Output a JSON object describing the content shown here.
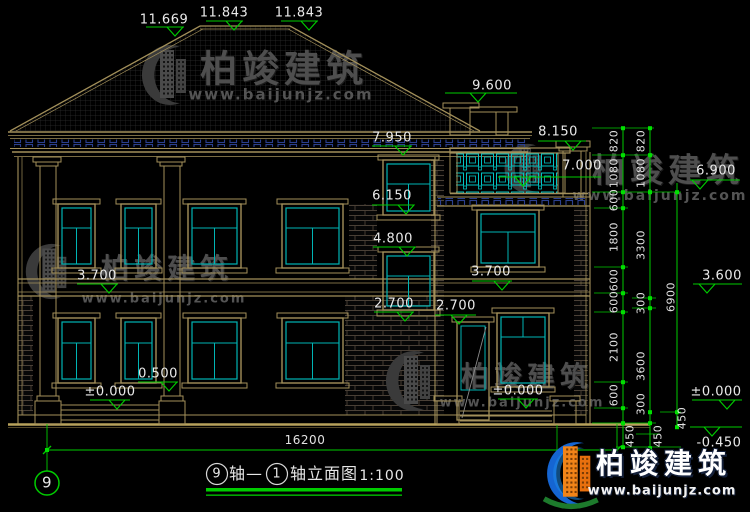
{
  "drawing": {
    "type": "building-elevation",
    "title": {
      "axis_left": "9",
      "mid": "轴—",
      "axis_right": "1",
      "suffix": "轴立面图",
      "scale": "1:100"
    },
    "axis_bubble": "9",
    "total_width_dim": "16200",
    "accent_colors": {
      "line_green": "#00cc00",
      "line_tan": "#a3905a",
      "line_cyan": "#00b4b4",
      "dentil_navy": "#2b3f8e",
      "text_white": "#eaeaea",
      "watermark_gray": "#4e4e4e",
      "logo_blue": "#1565d2",
      "logo_orange": "#f28418",
      "logo_green": "#1d7a2c"
    },
    "level_markers": [
      "11.669",
      "11.843",
      "11.843",
      "9.600",
      "8.150",
      "7.950",
      "7.000",
      "6.900",
      "6.150",
      "4.800",
      "3.700",
      "3.700",
      "3.600",
      "2.700",
      "2.700",
      "0.500",
      "±0.000",
      "±0.000",
      "±0.000",
      "-0.450"
    ],
    "right_dim_chain_1": [
      "820",
      "1080",
      "600",
      "1800",
      "600",
      "600",
      "2100",
      "600",
      "450"
    ],
    "right_dim_chain_2": [
      "820",
      "1080",
      "3300",
      "300",
      "3600",
      "300",
      "450"
    ],
    "right_dim_total": [
      "6900",
      "450"
    ]
  },
  "watermark": {
    "brand": "柏竣建筑",
    "url": "www.baijunjz.com"
  },
  "labels": [
    {
      "n": "watermark-brand",
      "t": "柏竣建筑",
      "x": 284,
      "y": 69,
      "fs": 37,
      "cls": "wmbig",
      "layer": "wm"
    },
    {
      "n": "watermark-url",
      "t": "www.baijunjz.com",
      "x": 281,
      "y": 95,
      "fs": 15,
      "cls": "wmurl",
      "layer": "wm"
    },
    {
      "n": "watermark-brand",
      "t": "柏竣建筑",
      "x": 668,
      "y": 170,
      "fs": 33,
      "cls": "wmbig",
      "layer": "wm"
    },
    {
      "n": "watermark-url",
      "t": "www.baijunjz.com",
      "x": 660,
      "y": 196,
      "fs": 14,
      "cls": "wmurl",
      "layer": "wm"
    },
    {
      "n": "watermark-brand",
      "t": "柏竣建筑",
      "x": 167,
      "y": 269,
      "fs": 28,
      "cls": "wmbig",
      "layer": "wm"
    },
    {
      "n": "watermark-url",
      "t": "www.baijunjz.com",
      "x": 164,
      "y": 299,
      "fs": 13,
      "cls": "wmurl",
      "layer": "wm"
    },
    {
      "n": "watermark-brand",
      "t": "柏竣建筑",
      "x": 527,
      "y": 377,
      "fs": 28,
      "cls": "wmbig",
      "layer": "wm"
    },
    {
      "n": "watermark-url",
      "t": "www.baijunjz.com",
      "x": 522,
      "y": 403,
      "fs": 13,
      "cls": "wmurl",
      "layer": "wm"
    },
    {
      "n": "level-label",
      "t": "11.669",
      "x": 164,
      "y": 20,
      "fs": 13,
      "cls": "lvl"
    },
    {
      "n": "level-label",
      "t": "11.843",
      "x": 224,
      "y": 13,
      "fs": 13,
      "cls": "lvl"
    },
    {
      "n": "level-label",
      "t": "11.843",
      "x": 299,
      "y": 13,
      "fs": 13,
      "cls": "lvl"
    },
    {
      "n": "level-label",
      "t": "9.600",
      "x": 492,
      "y": 86,
      "fs": 13,
      "cls": "lvl"
    },
    {
      "n": "level-label",
      "t": "8.150",
      "x": 558,
      "y": 132,
      "fs": 13,
      "cls": "lvl"
    },
    {
      "n": "level-label",
      "t": "7.950",
      "x": 392,
      "y": 138,
      "fs": 13,
      "cls": "lvl"
    },
    {
      "n": "level-label",
      "t": "7.000",
      "x": 582,
      "y": 166,
      "fs": 13,
      "cls": "lvl"
    },
    {
      "n": "level-label",
      "t": "6.900",
      "x": 716,
      "y": 171,
      "fs": 13,
      "cls": "lvl"
    },
    {
      "n": "level-label",
      "t": "6.150",
      "x": 392,
      "y": 196,
      "fs": 13,
      "cls": "lvl"
    },
    {
      "n": "level-label",
      "t": "4.800",
      "x": 393,
      "y": 239,
      "fs": 13,
      "cls": "lvl"
    },
    {
      "n": "level-label",
      "t": "3.700",
      "x": 97,
      "y": 276,
      "fs": 13,
      "cls": "lvl"
    },
    {
      "n": "level-label",
      "t": "3.700",
      "x": 491,
      "y": 272,
      "fs": 13,
      "cls": "lvl"
    },
    {
      "n": "level-label",
      "t": "3.600",
      "x": 722,
      "y": 276,
      "fs": 13,
      "cls": "lvl"
    },
    {
      "n": "level-label",
      "t": "2.700",
      "x": 394,
      "y": 304,
      "fs": 13,
      "cls": "lvl"
    },
    {
      "n": "level-label",
      "t": "2.700",
      "x": 456,
      "y": 306,
      "fs": 13,
      "cls": "lvl"
    },
    {
      "n": "level-label",
      "t": "0.500",
      "x": 158,
      "y": 374,
      "fs": 13,
      "cls": "lvl"
    },
    {
      "n": "level-label",
      "t": "±0.000",
      "x": 110,
      "y": 392,
      "fs": 13,
      "cls": "lvl"
    },
    {
      "n": "level-label",
      "t": "±0.000",
      "x": 518,
      "y": 391,
      "fs": 13,
      "cls": "lvl"
    },
    {
      "n": "level-label",
      "t": "±0.000",
      "x": 716,
      "y": 392,
      "fs": 13,
      "cls": "lvl"
    },
    {
      "n": "level-label",
      "t": "-0.450",
      "x": 719,
      "y": 443,
      "fs": 13,
      "cls": "lvl"
    },
    {
      "n": "dim-total-width",
      "t": "16200",
      "x": 305,
      "y": 440,
      "fs": 12,
      "cls": "dim"
    },
    {
      "n": "dim-chain1",
      "t": "820",
      "x": 614,
      "y": 141,
      "fs": 11,
      "cls": "dim",
      "rot": 1
    },
    {
      "n": "dim-chain1",
      "t": "1080",
      "x": 614,
      "y": 173,
      "fs": 11,
      "cls": "dim",
      "rot": 1
    },
    {
      "n": "dim-chain1",
      "t": "600",
      "x": 614,
      "y": 200,
      "fs": 11,
      "cls": "dim",
      "rot": 1
    },
    {
      "n": "dim-chain1",
      "t": "1800",
      "x": 614,
      "y": 237,
      "fs": 11,
      "cls": "dim",
      "rot": 1
    },
    {
      "n": "dim-chain1",
      "t": "600",
      "x": 614,
      "y": 280,
      "fs": 11,
      "cls": "dim",
      "rot": 1
    },
    {
      "n": "dim-chain1",
      "t": "600",
      "x": 614,
      "y": 302,
      "fs": 11,
      "cls": "dim",
      "rot": 1
    },
    {
      "n": "dim-chain1",
      "t": "2100",
      "x": 614,
      "y": 347,
      "fs": 11,
      "cls": "dim",
      "rot": 1
    },
    {
      "n": "dim-chain1",
      "t": "600",
      "x": 614,
      "y": 395,
      "fs": 11,
      "cls": "dim",
      "rot": 1
    },
    {
      "n": "dim-chain1",
      "t": "450",
      "x": 630,
      "y": 436,
      "fs": 11,
      "cls": "dim",
      "rot": 1
    },
    {
      "n": "dim-chain2",
      "t": "820",
      "x": 641,
      "y": 141,
      "fs": 11,
      "cls": "dim",
      "rot": 1
    },
    {
      "n": "dim-chain2",
      "t": "1080",
      "x": 641,
      "y": 173,
      "fs": 11,
      "cls": "dim",
      "rot": 1
    },
    {
      "n": "dim-chain2",
      "t": "3300",
      "x": 641,
      "y": 245,
      "fs": 11,
      "cls": "dim",
      "rot": 1
    },
    {
      "n": "dim-chain2",
      "t": "300",
      "x": 641,
      "y": 303,
      "fs": 11,
      "cls": "dim",
      "rot": 1
    },
    {
      "n": "dim-chain2",
      "t": "3600",
      "x": 641,
      "y": 366,
      "fs": 11,
      "cls": "dim",
      "rot": 1
    },
    {
      "n": "dim-chain2",
      "t": "300",
      "x": 641,
      "y": 404,
      "fs": 11,
      "cls": "dim",
      "rot": 1
    },
    {
      "n": "dim-chain2",
      "t": "450",
      "x": 658,
      "y": 436,
      "fs": 11,
      "cls": "dim",
      "rot": 1
    },
    {
      "n": "dim-total-height",
      "t": "6900",
      "x": 671,
      "y": 297,
      "fs": 11,
      "cls": "dim",
      "rot": 1
    },
    {
      "n": "dim-total-height",
      "t": "450",
      "x": 682,
      "y": 418,
      "fs": 11,
      "cls": "dim",
      "rot": 1
    },
    {
      "n": "axis-bubble-number",
      "t": "9",
      "x": 47,
      "y": 483,
      "fs": 15,
      "cls": "lvl"
    },
    {
      "n": "title-axis-left",
      "t": "9",
      "x": 217,
      "y": 474,
      "fs": 13,
      "cls": "ttl"
    },
    {
      "n": "title-mid",
      "t": "轴—",
      "x": 246,
      "y": 474,
      "fs": 16,
      "cls": "ttl"
    },
    {
      "n": "title-axis-right",
      "t": "1",
      "x": 277,
      "y": 474,
      "fs": 13,
      "cls": "ttl"
    },
    {
      "n": "title-suffix",
      "t": "轴立面图",
      "x": 324,
      "y": 474,
      "fs": 16,
      "cls": "ttl"
    },
    {
      "n": "title-scale",
      "t": "1:100",
      "x": 382,
      "y": 476,
      "fs": 14,
      "cls": "ttl"
    },
    {
      "n": "logo-brand",
      "t": "柏竣建筑",
      "x": 664,
      "y": 464,
      "fs": 28,
      "cls": "logotxt"
    },
    {
      "n": "logo-url",
      "t": "www.baijunjz.com",
      "x": 662,
      "y": 491,
      "fs": 13,
      "cls": "logourl"
    }
  ]
}
